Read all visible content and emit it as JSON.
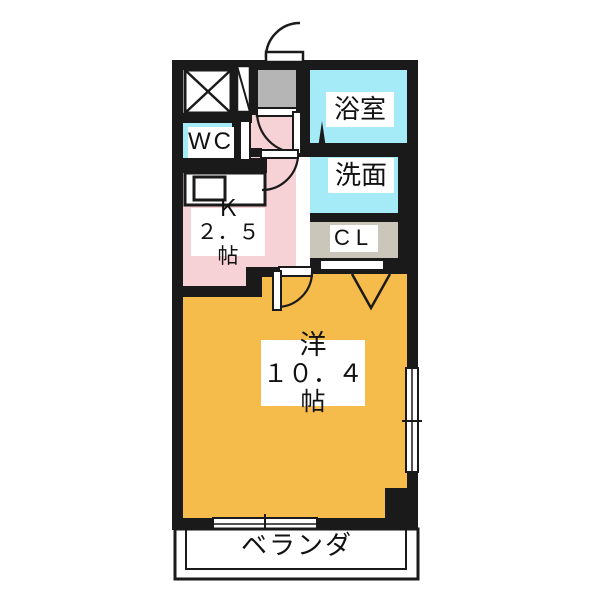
{
  "floor_plan": {
    "type": "japanese-apartment-floor-plan",
    "labels": {
      "bathroom": "浴室",
      "toilet": "WC",
      "washroom": "洗面",
      "kitchen_name": "Ｋ",
      "kitchen_size": "２．５帖",
      "closet": "CL",
      "main_room_name": "洋",
      "main_room_size": "１０．４帖",
      "veranda": "ベランダ"
    },
    "colors": {
      "wall": "#1a1a1a",
      "wet_area_cyan": "#a5ebf7",
      "kitchen_pink": "#f6d2d6",
      "entry_gray": "#b5b5b5",
      "closet_beige": "#cac6ba",
      "main_room_orange": "#f5bb4b",
      "fixture_white": "#ffffff"
    }
  }
}
